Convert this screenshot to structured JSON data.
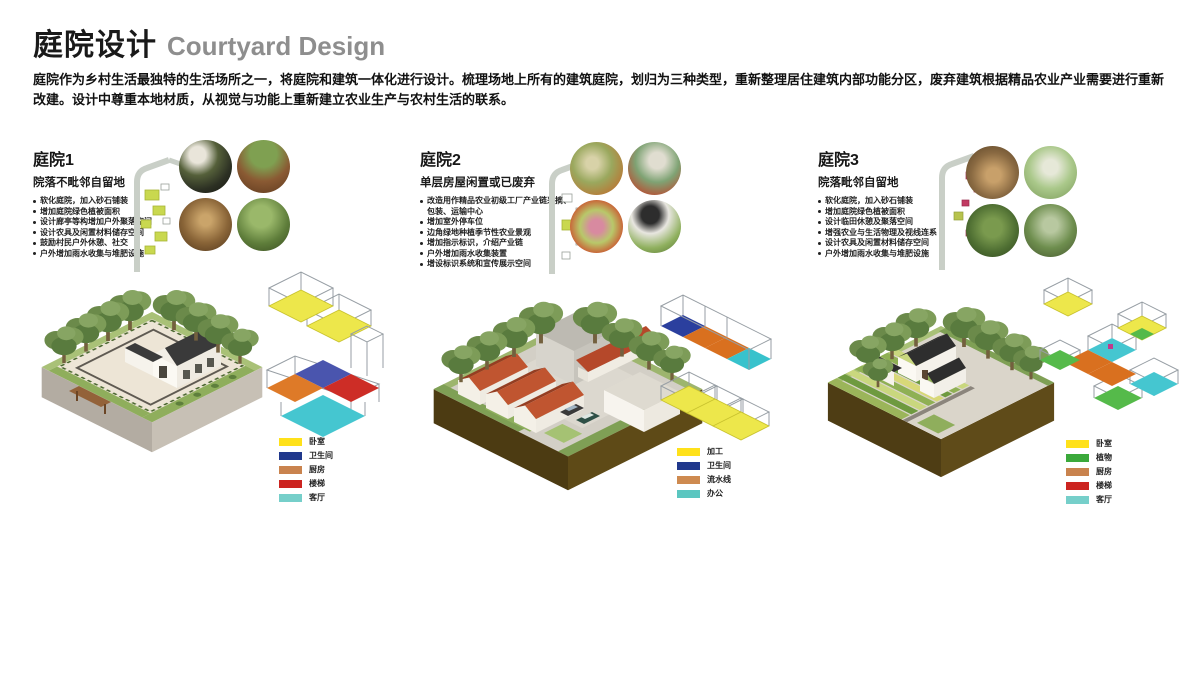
{
  "header": {
    "title_zh": "庭院设计",
    "title_en": "Courtyard Design",
    "description": "庭院作为乡村生活最独特的生活场所之一，将庭院和建筑一体化进行设计。梳理场地上所有的建筑庭院，划归为三种类型，重新整理居住建筑内部功能分区，废弃建筑根据精品农业产业需要进行重新改建。设计中尊重本地材质，从视觉与功能上重新建立农业生产与农村生活的联系。"
  },
  "colors": {
    "yellow": "#FFE11A",
    "navy": "#20388C",
    "brown": "#C9834E",
    "red": "#CC2420",
    "cyan": "#76CFCA",
    "orange": "#CE8A50",
    "teal": "#5BC6C0",
    "green": "#3BA93B"
  },
  "sections": [
    {
      "title": "庭院1",
      "subtitle": "院落不毗邻自留地",
      "bullets": [
        "软化庭院，加入砂石铺装",
        "增加庭院绿色植被面积",
        "设计廊亭等构增加户外聚落空间",
        "设计农具及闲置材料储存空间",
        "鼓励村民户外休憩、社交",
        "户外增加雨水收集与堆肥设施"
      ],
      "photos": [
        "compost-bowl",
        "planter-barrel",
        "tool-shed-interior",
        "courtyard-plants"
      ],
      "legend": [
        {
          "color": "#FFE11A",
          "label": "卧室"
        },
        {
          "color": "#20388C",
          "label": "卫生间"
        },
        {
          "color": "#C9834E",
          "label": "厨房"
        },
        {
          "color": "#CC2420",
          "label": "楼梯"
        },
        {
          "color": "#76CFCA",
          "label": "客厅"
        }
      ]
    },
    {
      "title": "庭院2",
      "subtitle": "单层房屋闲置或已废弃",
      "bullets": [
        "改造用作精品农业初级工厂产业链采摘、包装、运输中心",
        "增加室外停车位",
        "边角绿地种植季节性农业景观",
        "增加指示标识，介绍产业链",
        "户外增加雨水收集装置",
        "增设标识系统和宣传展示空间"
      ],
      "photos": [
        "vegetable-market",
        "produce-packing",
        "packaged-produce",
        "produce-sorting"
      ],
      "legend": [
        {
          "color": "#FFE11A",
          "label": "加工"
        },
        {
          "color": "#20388C",
          "label": "卫生间"
        },
        {
          "color": "#CE8A50",
          "label": "流水线"
        },
        {
          "color": "#5BC6C0",
          "label": "办公"
        }
      ]
    },
    {
      "title": "庭院3",
      "subtitle": "院落毗邻自留地",
      "bullets": [
        "软化庭院，加入砂石铺装",
        "增加庭院绿色植被面积",
        "设计临田休憩及聚落空间",
        "增强农业与生活物理及视线连系",
        "设计农具及闲置材料储存空间",
        "户外增加雨水收集与堆肥设施"
      ],
      "photos": [
        "wooden-shed-visit",
        "greenhouse-interior",
        "garden-work",
        "courtyard-greenery"
      ],
      "legend": [
        {
          "color": "#FFE11A",
          "label": "卧室"
        },
        {
          "color": "#3BA93B",
          "label": "植物"
        },
        {
          "color": "#C9834E",
          "label": "厨房"
        },
        {
          "color": "#CC2420",
          "label": "楼梯"
        },
        {
          "color": "#76CFCA",
          "label": "客厅"
        }
      ]
    }
  ]
}
